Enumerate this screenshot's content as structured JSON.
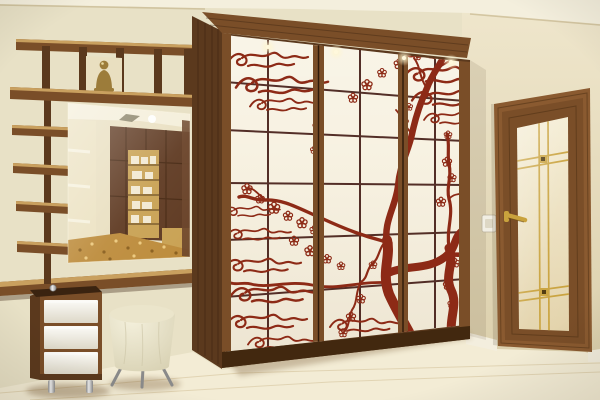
{
  "scene": {
    "description": "Photograph of a hallway interior: a large three-door sliding wardrobe decorated with a red Japanese cherry-blossom tree and wave-cloud mural on cream shoji-style grid panels, a wall-mounted wooden shelf ladder with a Buddha figurine, a frameless mirror reflecting the room, a wooden console shelf, a white three-drawer cabinet on chrome legs, a round cream pouf on metal legs, and a wooden interior door with a frosted glass insert and golden lattice.",
    "objects": [
      {
        "name": "wardrobe",
        "label": "Three-door sliding wardrobe with sakura mural",
        "doors": 3,
        "panel_columns": 6,
        "panel_rows": 6
      },
      {
        "name": "mural",
        "label": "Red cherry-blossom tree with stylized wave clouds"
      },
      {
        "name": "cornice-lights",
        "label": "Recessed spotlights in wardrobe cornice",
        "count": 4
      },
      {
        "name": "shelf-unit",
        "label": "Wall-mounted wooden shelf ladder",
        "ladder_shelves": 4
      },
      {
        "name": "buddha-figurine",
        "label": "Bronze Buddha figurine on shelf"
      },
      {
        "name": "mirror",
        "label": "Wall mirror reflecting room with cabinets and patterned carpet"
      },
      {
        "name": "console-shelf",
        "label": "Wooden console shelf under mirror"
      },
      {
        "name": "drawer-cabinet",
        "label": "White drawer cabinet on chrome legs",
        "drawers": 3
      },
      {
        "name": "pouf",
        "label": "Round cream pouf on splayed metal legs",
        "legs": 3
      },
      {
        "name": "door",
        "label": "Wooden door with frosted glass and golden lattice"
      },
      {
        "name": "door-handle",
        "label": "Golden lever door handle"
      },
      {
        "name": "light-switch",
        "label": "White wall light switch"
      },
      {
        "name": "floor",
        "label": "Light cream laminate floor"
      },
      {
        "name": "baseboard",
        "label": "White baseboard"
      }
    ]
  },
  "colors": {
    "wall": "#e8e1c6",
    "wall_right": "#e3d8ba",
    "ceiling": "#f4efdd",
    "floor": "#f3ecd5",
    "wood": "#7a4e28",
    "wood_dark": "#5b391d",
    "wood_darker": "#3a2310",
    "wood_light": "#c9a05f",
    "panel": "#f7f1e0",
    "grid": "#3d140e",
    "mural": "#8d2a16",
    "gold": "#c9a23d",
    "glass": "#efe5c7",
    "door_wood": "#8a5a30",
    "drawer": "#f8f5ee",
    "chrome": "#c6c6c6",
    "pouf": "#ebe5cb",
    "buddha": "#9c7c3a",
    "carpet": "#bd8c3c",
    "mirror_wall": "#e9dfc0",
    "cabinet": "#5f3a22",
    "shelf_gold": "#c9a254",
    "switch": "#f1eee3",
    "baseboard": "#f3eede",
    "plinth": "#42280f"
  }
}
